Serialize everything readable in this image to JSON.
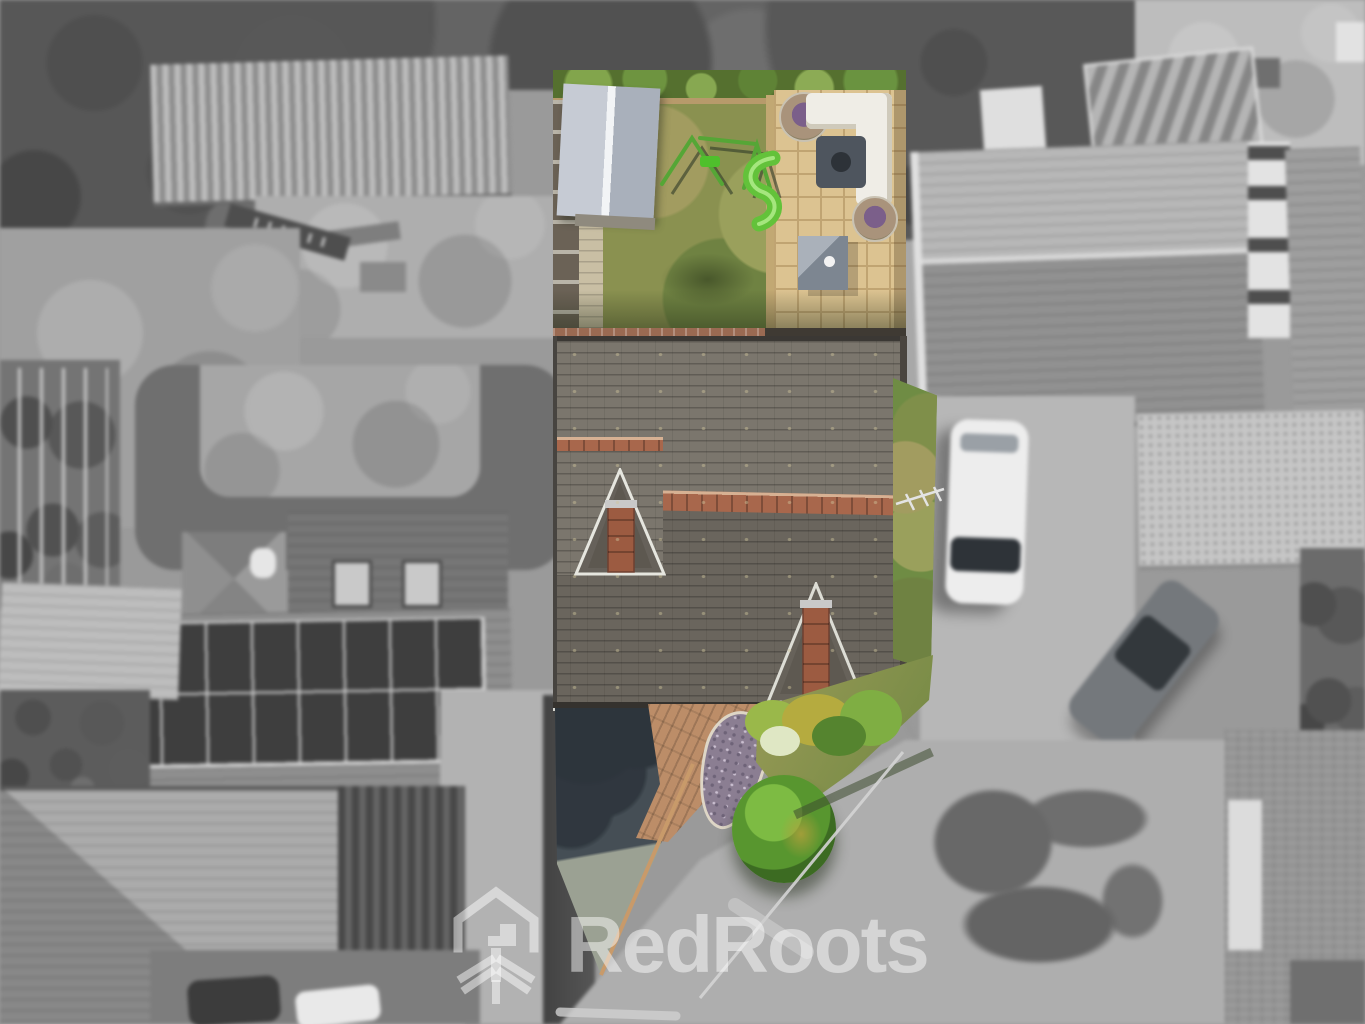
{
  "image": {
    "kind": "aerial drone photograph of a property listing",
    "effect": "subject property shown in colour, surrounding houses desaturated to greyscale"
  },
  "watermark": {
    "brand": "RedRoots",
    "logo": "house-with-roots",
    "color": "#ffffff"
  },
  "palette": {
    "lawn_green": "#8a9150",
    "hedge_green": "#55702f",
    "patio_paving": "#dcc391",
    "shed_grey": "#bcc2cb",
    "roof_slate": "#6f6a62",
    "ridge_brick": "#a8674c",
    "chimney_brick": "#9c5b41",
    "driveway_tarmac": "#454e55",
    "path_brick": "#bc8d68",
    "slate_mulch_bed": "#8b7e92",
    "bush_green": "#66a637",
    "bush_gold": "#b3a03c",
    "slide_green": "#63c23a",
    "surroundings_grey": "#9a9a9a"
  },
  "property_features": [
    "rear garden lawn",
    "garden shed",
    "children's swing set",
    "green toddler slide",
    "paved patio seating area",
    "white corner sofa",
    "two hanging egg chairs",
    "grey fire-pit table",
    "grey storage cube",
    "slate roof with red brick ridge",
    "two gable chimneys",
    "tv aerial",
    "side lawn strip",
    "dark tarmac driveway",
    "curved brick path",
    "teardrop slate flower bed",
    "front shrubs and round bush",
    "front lawn"
  ],
  "surroundings_features": [
    "neighbour roof with solar panel array",
    "corrugated garage roof",
    "neighbour patio",
    "large grey hipped roofs",
    "conservatory",
    "gravel forecourt",
    "white parked car",
    "grey parked car",
    "cars at bottom edge",
    "road junction with tree shadow",
    "kerb lines"
  ]
}
